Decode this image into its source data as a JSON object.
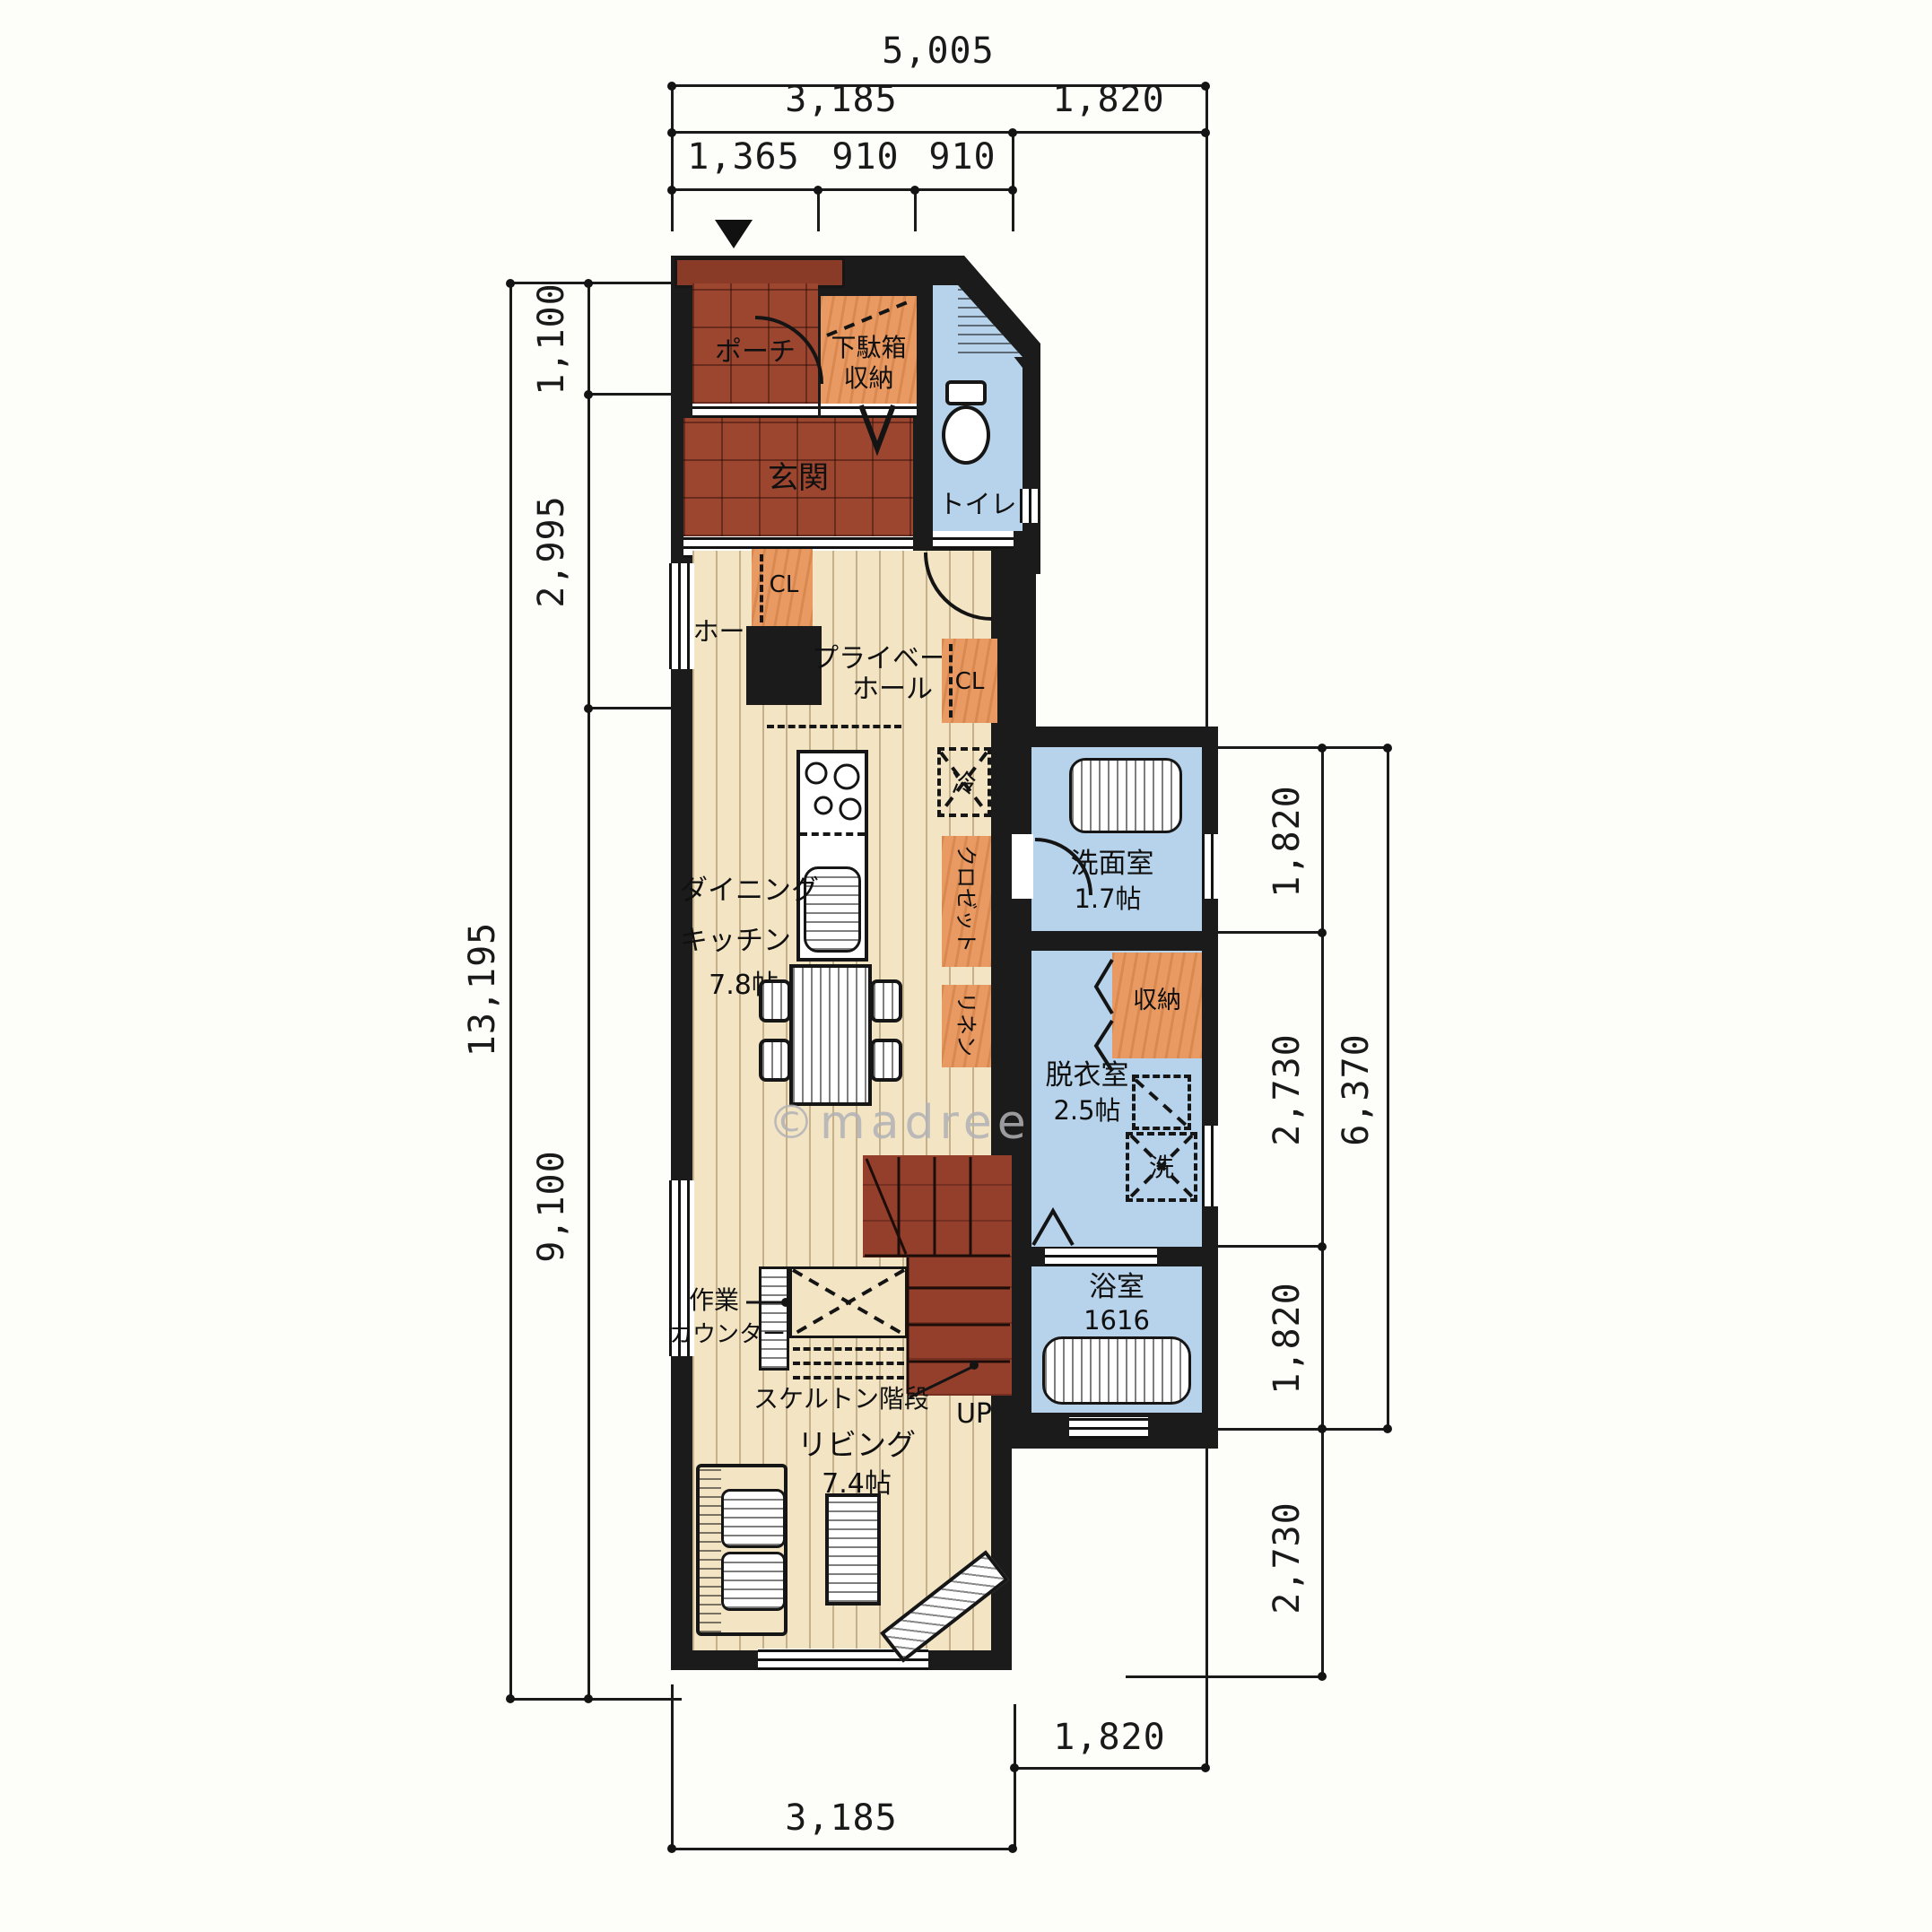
{
  "type": "architectural-floor-plan",
  "watermark": "©madree",
  "colors": {
    "wall": "#1b1b1b",
    "floor_wood": "#f3e4c4",
    "tile_red": "#9c4630",
    "canopy_red": "#8a3b28",
    "storage_orange": "#e99a63",
    "wet_blue": "#b7d3eb",
    "stair_red": "#943f2c",
    "dim_line": "#1a1a1a",
    "watermark_gray": "#b2b2b6"
  },
  "dims": {
    "t5005": "5,005",
    "t3185": "3,185",
    "t1820": "1,820",
    "t1365": "1,365",
    "t910a": "910",
    "t910b": "910",
    "l13195": "13,195",
    "l1100": "1,100",
    "l2995": "2,995",
    "l9100": "9,100",
    "r1820a": "1,820",
    "r2730a": "2,730",
    "r1820b": "1,820",
    "r6370": "6,370",
    "r2730b": "2,730",
    "b1820": "1,820",
    "b3185": "3,185"
  },
  "rooms": {
    "porch": {
      "name": "ポーチ"
    },
    "shoe": {
      "line1": "下駄箱",
      "line2": "収納"
    },
    "toilet": {
      "name": "トイレ"
    },
    "entrance": {
      "name": "玄関"
    },
    "hall": {
      "name": "ホール"
    },
    "closet1": {
      "name": "CL"
    },
    "private_hall": {
      "line1": "プライベート",
      "line2": "ホール"
    },
    "closet2": {
      "name": "CL"
    },
    "dk": {
      "line1": "ダイニング",
      "line2": "キッチン",
      "size": "7.8帖"
    },
    "pantry_upper": {
      "name": "クロゼット"
    },
    "pantry_lower": {
      "name": "リネン"
    },
    "washroom": {
      "name": "洗面室",
      "size": "1.7帖"
    },
    "wing_storage": {
      "name": "収納"
    },
    "dressing": {
      "name": "脱衣室",
      "size": "2.5帖"
    },
    "bathroom": {
      "name": "浴室",
      "size": "1616"
    },
    "living": {
      "name": "リビング",
      "size": "7.4帖"
    }
  },
  "fixtures": {
    "fridge": "冷",
    "washer": "洗",
    "up": "UP"
  },
  "annotations": {
    "work_counter_line1": "作業",
    "work_counter_line2": "カウンター",
    "stairs": "スケルトン階段"
  }
}
